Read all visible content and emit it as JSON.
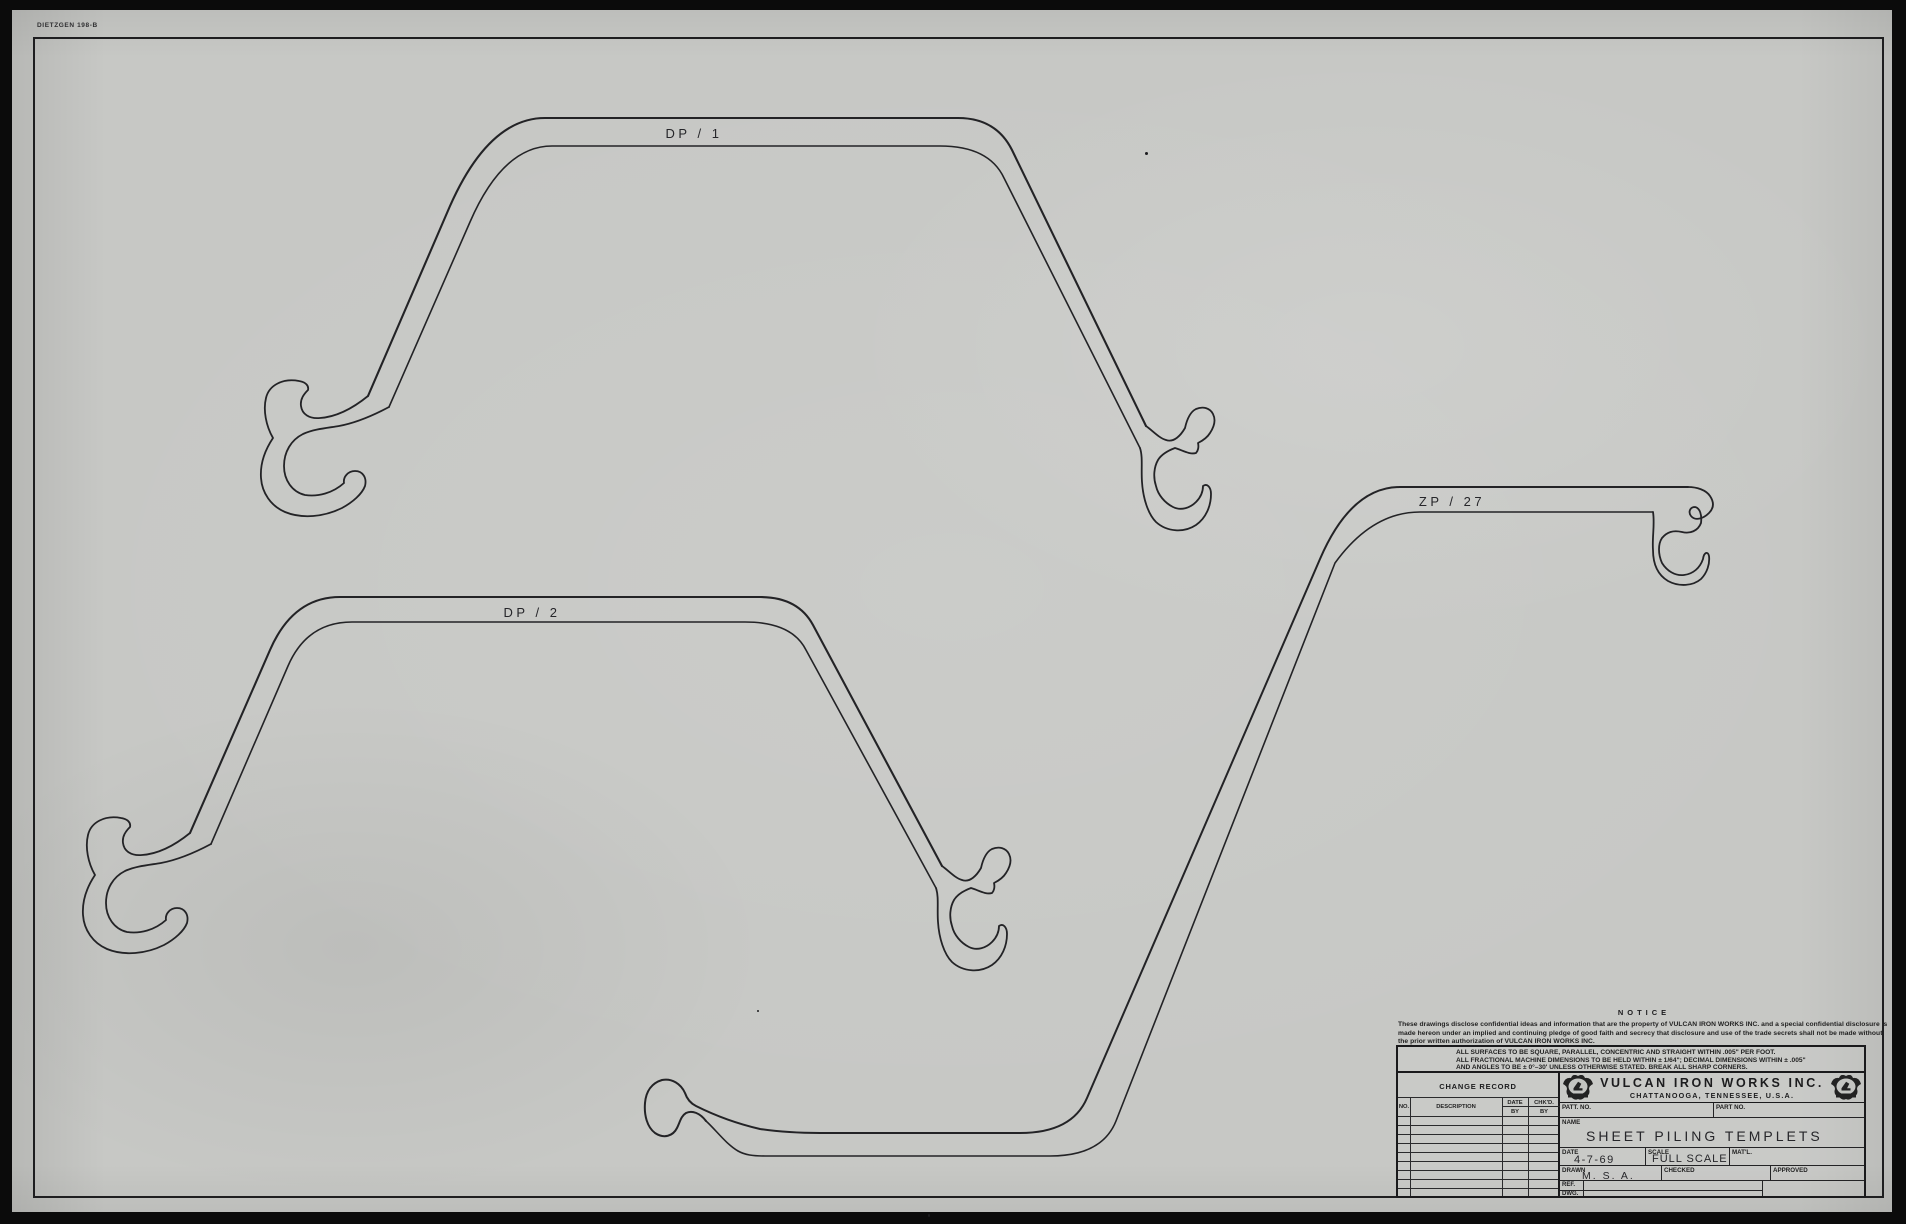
{
  "sheet": {
    "paper_mark": "DIETZGEN 198-B",
    "piling_labels": {
      "dp1": "DP / 1",
      "dp2": "DP / 2",
      "zp27": "ZP / 27"
    }
  },
  "notice": {
    "heading": "NOTICE",
    "line1": "These drawings disclose confidential ideas and information that are the property of VULCAN IRON WORKS INC. and a special confidential disclosure is",
    "line2": "made hereon under an implied and continuing pledge of good faith and secrecy that disclosure and use of the trade secrets shall not be made without",
    "line3": "the prior written authorization of VULCAN IRON WORKS INC."
  },
  "tolerances": {
    "line1": "ALL SURFACES TO BE SQUARE, PARALLEL, CONCENTRIC AND STRAIGHT WITHIN .005\" PER FOOT.",
    "line2": "ALL FRACTIONAL MACHINE DIMENSIONS TO BE HELD WITHIN ± 1/64\"; DECIMAL DIMENSIONS WITHIN ± .005\"",
    "line3": "AND ANGLES TO BE ± 0°–30' UNLESS OTHERWISE STATED. BREAK ALL SHARP CORNERS."
  },
  "change_record": {
    "title": "CHANGE RECORD",
    "columns": {
      "no": "NO.",
      "description": "DESCRIPTION",
      "date": "DATE",
      "chkd": "CHK'D.",
      "by": "BY"
    }
  },
  "title_block": {
    "company_name": "VULCAN IRON WORKS INC.",
    "company_location": "CHATTANOOGA, TENNESSEE, U.S.A.",
    "patt_no_label": "PATT. NO.",
    "part_no_label": "PART NO.",
    "name_label": "NAME",
    "drawing_name": "SHEET PILING TEMPLETS",
    "date_label": "DATE",
    "date_value": "4-7-69",
    "scale_label": "SCALE",
    "scale_value": "FULL SCALE",
    "matl_label": "MAT'L.",
    "drawn_label": "DRAWN",
    "drawn_value": "M. S. A.",
    "checked_label": "CHECKED",
    "approved_label": "APPROVED",
    "ref_label": "REF.",
    "dwg_label": "DWG."
  },
  "colors": {
    "paper": "#c7c8c5",
    "ink": "#1c1c1e",
    "photo_border": "#0b0b0b"
  }
}
